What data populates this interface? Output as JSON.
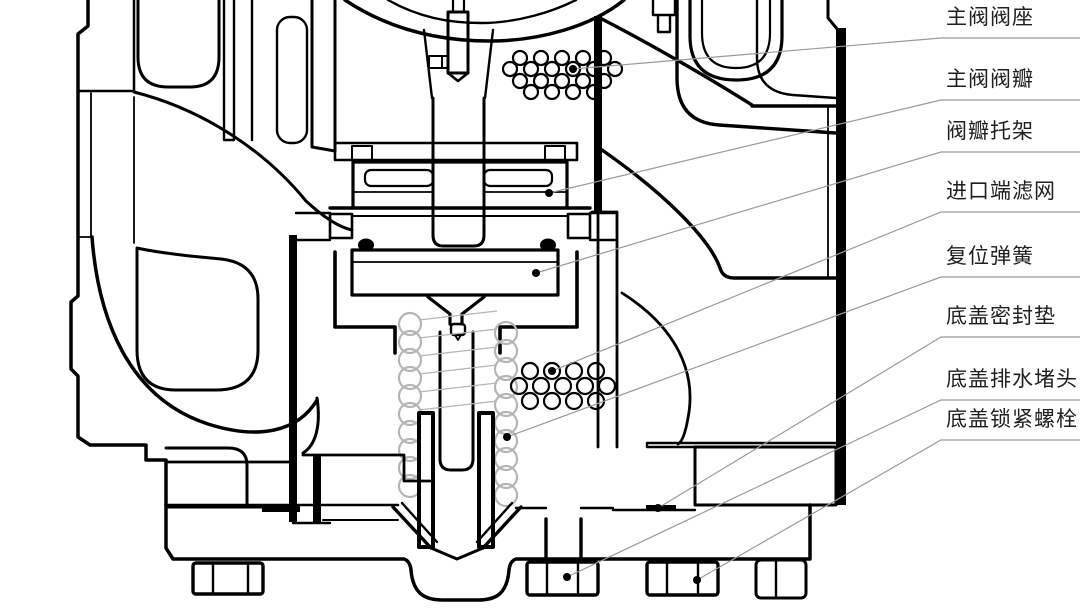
{
  "diagram": {
    "title": "减压阀主阀剖视图",
    "type": "engineering-cross-section",
    "subject": "pilot-operated pressure reducing valve, main valve lower section",
    "colors": {
      "outline": "#000000",
      "leader_line": "#9a9a9a",
      "spring_coil": "#b5b5b5",
      "label_text": "#1f1f1f",
      "background": "#ffffff"
    },
    "callouts": [
      {
        "label": "主阀阀座",
        "dot": [
          573,
          69
        ],
        "bend": [
          941,
          38
        ]
      },
      {
        "label": "主阀阀瓣",
        "dot": [
          549,
          193
        ],
        "bend": [
          941,
          100
        ]
      },
      {
        "label": "阀瓣托架",
        "dot": [
          536,
          273
        ],
        "bend": [
          941,
          152
        ]
      },
      {
        "label": "进口端滤网",
        "dot": [
          552,
          371
        ],
        "bend": [
          941,
          212
        ]
      },
      {
        "label": "复位弹簧",
        "dot": [
          507,
          437
        ],
        "bend": [
          941,
          277
        ]
      },
      {
        "label": "底盖密封垫",
        "dot": [
          658,
          508
        ],
        "bend": [
          941,
          337
        ]
      },
      {
        "label": "底盖排水堵头",
        "dot": [
          567,
          577
        ],
        "bend": [
          941,
          400
        ]
      },
      {
        "label": "底盖锁紧螺栓",
        "dot": [
          697,
          580
        ],
        "bend": [
          941,
          440
        ]
      }
    ]
  }
}
